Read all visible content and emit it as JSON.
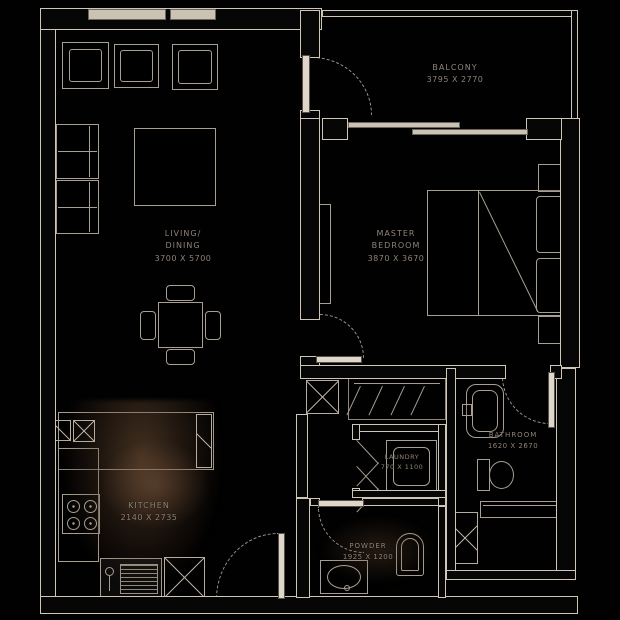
{
  "palette": {
    "background": "#000000",
    "wall_line": "#cfc6b8",
    "furniture_line": "#a89f92",
    "label_text": "#8f8478",
    "wood_smudge": "#6e5037"
  },
  "rooms": {
    "balcony": {
      "name": "BALCONY",
      "dims": "3795 x 2770"
    },
    "living_dining": {
      "name_line1": "LIVING/",
      "name_line2": "DINING",
      "dims": "3700 x 5700"
    },
    "master_bedroom": {
      "name_line1": "MASTER",
      "name_line2": "BEDROOM",
      "dims": "3870 x 3670"
    },
    "kitchen": {
      "name": "KITCHEN",
      "dims": "2140 x 2735"
    },
    "laundry": {
      "name": "LAUNDRY",
      "dims": "770 x 1100"
    },
    "bathroom": {
      "name": "BATHROOM",
      "dims": "1620 x 2670"
    },
    "powder": {
      "name": "POWDER",
      "dims": "1925 x 1200"
    }
  }
}
